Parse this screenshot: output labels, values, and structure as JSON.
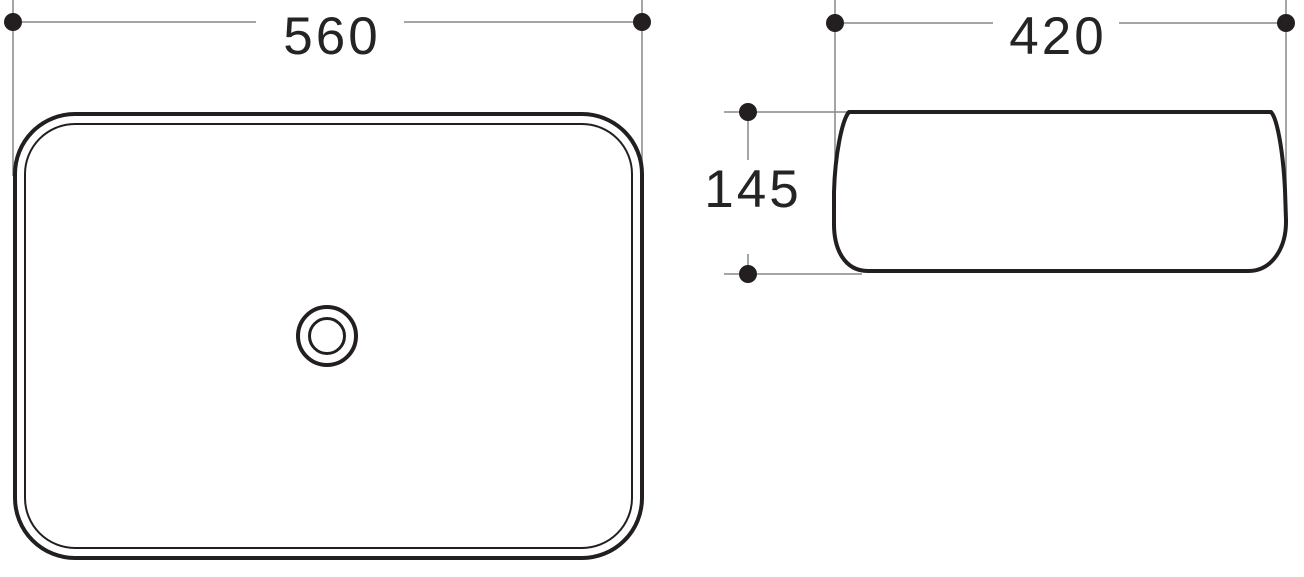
{
  "drawing": {
    "subject": "rectangular-countertop-basin",
    "views": {
      "top_view": {
        "name": "basin-top-view"
      },
      "side_view": {
        "name": "basin-side-view"
      }
    }
  },
  "dimensions": {
    "top_width": {
      "value": "560"
    },
    "side_width": {
      "value": "420"
    },
    "side_height": {
      "value": "145"
    }
  },
  "colors": {
    "outline": "#231f20",
    "thin_line": "#878787",
    "text": "#252326",
    "background": "#ffffff"
  }
}
